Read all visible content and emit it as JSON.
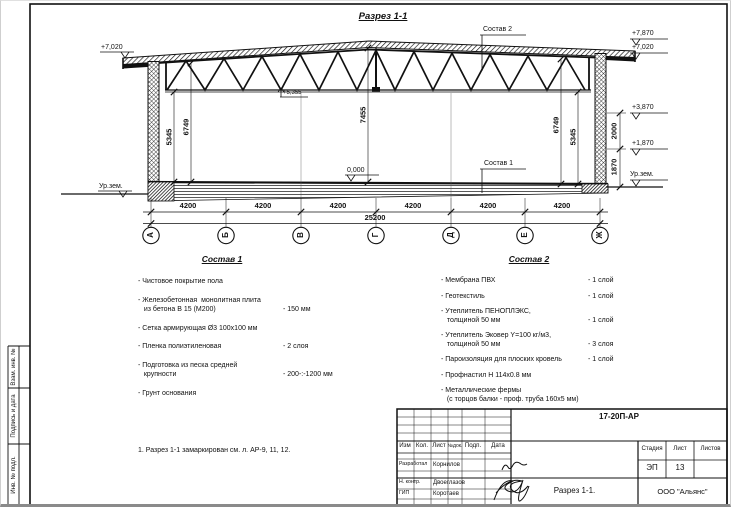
{
  "drawing": {
    "title": "Разрез 1-1",
    "labels": {
      "sostav2_leader": "Состав 2",
      "sostav1_leader": "Состав 1",
      "elev_left_top": "+7,020",
      "elev_left_ground": "Ур.зем.",
      "elev_bottom_chord": "+5,355",
      "elev_floor": "0,000",
      "elev_right_1": "+7,870",
      "elev_right_2": "+7,020",
      "elev_right_3": "+3,870",
      "elev_right_4": "+1,870",
      "elev_right_ground": "Ур.зем."
    },
    "dims": {
      "left_inner": "5345",
      "left_outer": "6749",
      "mid": "7455",
      "right_outer": "6749",
      "right_inner": "5345",
      "right_upper": "2000",
      "right_lower": "1870",
      "bays": [
        "4200",
        "4200",
        "4200",
        "4200",
        "4200",
        "4200"
      ],
      "total": "25200"
    },
    "axes": [
      "А",
      "Б",
      "В",
      "Г",
      "Д",
      "Е",
      "Ж"
    ]
  },
  "sostav1": {
    "title": "Состав 1",
    "items": [
      {
        "name": "- Чистовое покрытие пола",
        "value": ""
      },
      {
        "name": "- Железобетонная  монолитная плита\n   из бетона В 15 (М200)",
        "value": "- 150 мм"
      },
      {
        "name": "- Сетка армирующая Ø3 100х100 мм",
        "value": ""
      },
      {
        "name": "- Пленка полиэтиленовая",
        "value": "- 2 слоя"
      },
      {
        "name": "- Подготовка из песка средней\n   крупности",
        "value": "- 200-:-1200 мм"
      },
      {
        "name": "- Грунт основания",
        "value": ""
      }
    ]
  },
  "sostav2": {
    "title": "Состав 2",
    "items": [
      {
        "name": "- Мембрана ПВХ",
        "value": "- 1 слой"
      },
      {
        "name": "- Геотекстиль",
        "value": "- 1 слой"
      },
      {
        "name": "- Утеплитель ПЕНОПЛЭКС,\n   толщиной 50 мм",
        "value": "- 1 слой"
      },
      {
        "name": "- Утеплитель Эковер Y=100 кг/м3,\n   толщиной 50 мм",
        "value": "- 3 слоя"
      },
      {
        "name": "- Пароизоляция для плоских кровель",
        "value": "- 1 слой"
      },
      {
        "name": "- Профнастил Н 114х0.8 мм",
        "value": ""
      },
      {
        "name": "- Металлические фермы\n   (с торцов балки - проф. труба 160х5 мм)",
        "value": ""
      }
    ]
  },
  "note": "1. Разрез 1-1 замаркирован см. л. АР-9, 11, 12.",
  "stamp": {
    "doc_code": "17-20П-АР",
    "cols": [
      "Изм",
      "Кол.",
      "Лист",
      "№док.",
      "Подп.",
      "Дата"
    ],
    "rows": [
      {
        "role": "Разработал",
        "name": "Корнилов"
      },
      {
        "role": "Н. контр.",
        "name": "Двоеглазов"
      },
      {
        "role": "ГИП",
        "name": "Коротаев"
      }
    ],
    "stage_label": "Стадия",
    "sheet_label": "Лист",
    "sheets_label": "Листов",
    "stage": "ЭП",
    "sheet": "13",
    "sheets": "",
    "title": "Разрез 1-1.",
    "company": "ООО \"Альянс\""
  },
  "side_strip": {
    "cells": [
      "Взам. инв. №",
      "Подпись и дата",
      "Инв. № подл."
    ]
  }
}
